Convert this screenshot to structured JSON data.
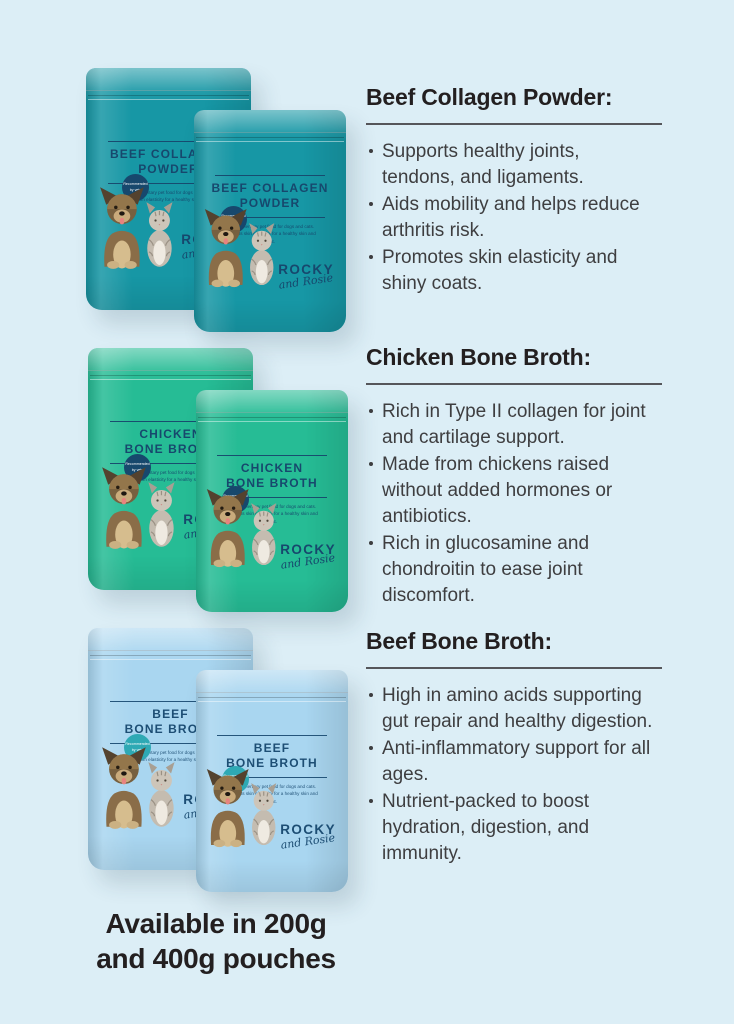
{
  "page": {
    "background_color": "#DCEEF6",
    "text_color": "#231F20"
  },
  "caption": {
    "lines": [
      "Available in 200g",
      "and 400g pouches"
    ]
  },
  "brand": {
    "name": "ROCKY",
    "script": "and Rosie"
  },
  "pouch_common": {
    "badge_text": "Recommended by vets",
    "fine_print": "Complementary pet food for dogs and cats. Supports skin elasticity for a healthy skin and coat.",
    "label_text_color": "#17486D"
  },
  "products": [
    {
      "name": "Beef Collagen Powder",
      "pouch": {
        "title_line1": "BEEF COLLAGEN",
        "title_line2": "POWDER",
        "bag_color": "#1797A5",
        "badge_color": "#17486D"
      },
      "info": {
        "heading": "Beef Collagen Powder:",
        "bullets": [
          "Supports healthy joints, tendons, and ligaments.",
          "Aids mobility and helps reduce arthritis risk.",
          "Promotes skin elasticity and shiny coats."
        ]
      }
    },
    {
      "name": "Chicken Bone Broth",
      "pouch": {
        "title_line1": "CHICKEN",
        "title_line2": "BONE BROTH",
        "bag_color": "#26BC95",
        "badge_color": "#17486D"
      },
      "info": {
        "heading": "Chicken Bone Broth:",
        "bullets": [
          "Rich in Type II collagen for joint and cartilage support.",
          "Made from chickens raised without added hormones or antibiotics.",
          "Rich in glucosamine and chondroitin to ease joint discomfort."
        ]
      }
    },
    {
      "name": "Beef Bone Broth",
      "pouch": {
        "title_line1": "BEEF",
        "title_line2": "BONE BROTH",
        "bag_color": "#A9D6F0",
        "badge_color": "#2EA9B4"
      },
      "info": {
        "heading": "Beef Bone Broth:",
        "bullets": [
          "High in amino acids supporting gut repair and healthy digestion.",
          "Anti-inflammatory support for all ages.",
          "Nutrient-packed to boost hydration, digestion, and immunity."
        ]
      }
    }
  ]
}
